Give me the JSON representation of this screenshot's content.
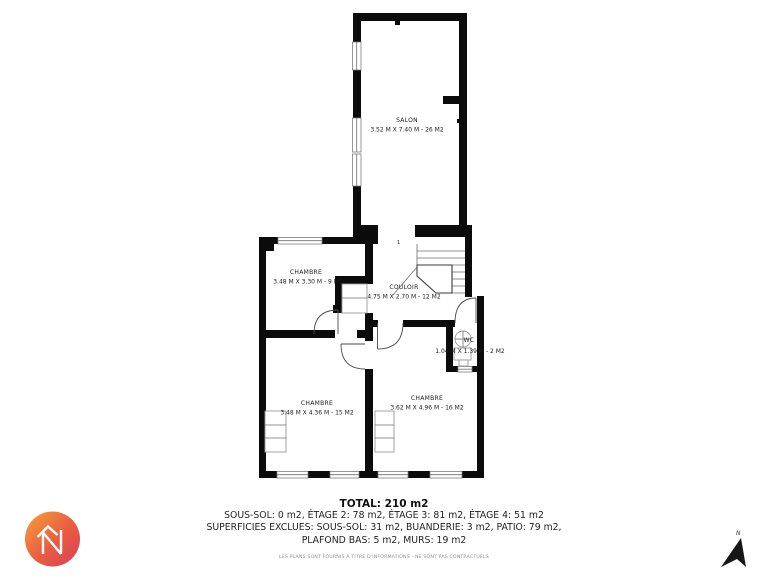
{
  "plan": {
    "rooms": [
      {
        "name": "SALON",
        "dims": "3.52 M X 7.40 M - 26 M2"
      },
      {
        "name": "CHAMBRE",
        "dims": "3.48 M X 3.30 M - 9 M2"
      },
      {
        "name": "COULOIR",
        "dims": "4.75 M X 2.70 M - 12 M2"
      },
      {
        "name": "WC",
        "dims": "1.04 M X 1.39 M - 2 M2"
      },
      {
        "name": "CHAMBRE",
        "dims": "3.48 M X 4.36 M - 15 M2"
      },
      {
        "name": "CHAMBRE",
        "dims": "3.62 M X 4.96 M - 16 M2"
      }
    ],
    "stair_mark": "1",
    "north_label": "N",
    "wall_color": "#0b0b0b"
  },
  "summary": {
    "total": "TOTAL: 210 m2",
    "line1": "SOUS-SOL: 0 m2, ÉTAGE 2: 78 m2, ÉTAGE 3: 81 m2, ÉTAGE 4: 51 m2",
    "line2": "SUPERFICIES EXCLUES: SOUS-SOL: 31 m2, BUANDERIE: 3 m2, PATIO: 79 m2,",
    "line3": "PLAFOND BAS: 5 m2, MURS: 19 m2",
    "disclaimer": "LES PLANS SONT FOURNIS À TITRE D'INFORMATIONS - NE SONT PAS CONTRACTUELS"
  },
  "logo": {
    "gradient_start": "#F6A03A",
    "gradient_mid": "#E95C41",
    "gradient_end": "#D84055"
  }
}
